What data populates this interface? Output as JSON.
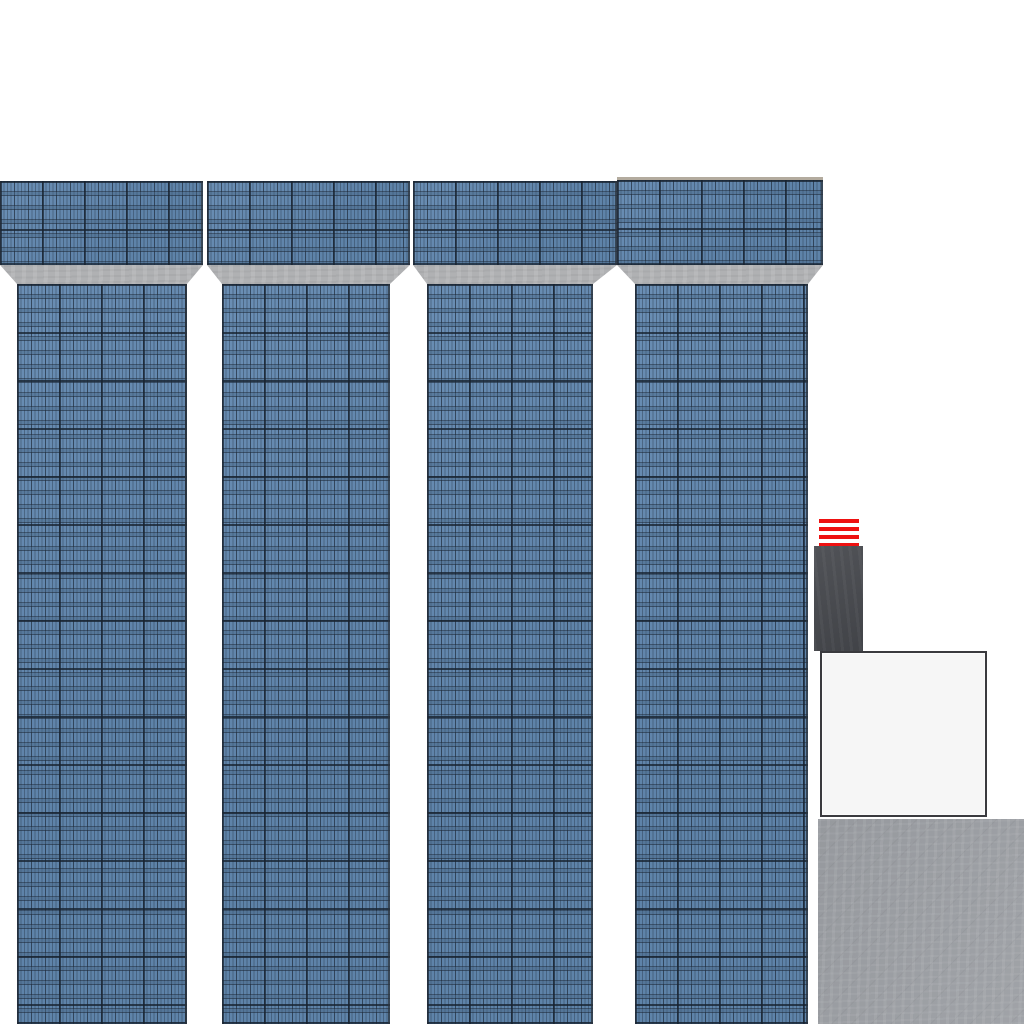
{
  "image": {
    "kind": "texture-atlas",
    "width_px": 1024,
    "height_px": 1024
  },
  "palette": {
    "background_white": "#ffffff",
    "facade_blue": "#6288b0",
    "facade_line_dark": "#1f2c3b",
    "ledge_gray": "#b0b1b3",
    "ledge_gray_light": "#babbbd",
    "trim_tan": "#b3ab9e",
    "stripe_red": "#ee1111",
    "dark_block_gray": "#47494e",
    "panel_fill": "#f6f6f6",
    "panel_border": "#3a3a3e",
    "concrete_gray": "#9b9ea3"
  },
  "sprites": {
    "facade_strips": [
      {
        "name": "facade-strip-1",
        "top": {
          "x": 0,
          "y": 181,
          "w": 203,
          "h": 84
        },
        "ledge": {
          "x": 0,
          "y": 265,
          "w": 203,
          "h": 19,
          "bottom_left": 17,
          "bottom_right": 187
        },
        "shaft": {
          "x": 17,
          "y": 284,
          "w": 170,
          "h": 740
        }
      },
      {
        "name": "facade-strip-2",
        "top": {
          "x": 207,
          "y": 181,
          "w": 203,
          "h": 84
        },
        "ledge": {
          "x": 207,
          "y": 265,
          "w": 203,
          "h": 19,
          "bottom_left": 222,
          "bottom_right": 390
        },
        "shaft": {
          "x": 222,
          "y": 284,
          "w": 168,
          "h": 740
        }
      },
      {
        "name": "facade-strip-3",
        "top": {
          "x": 413,
          "y": 181,
          "w": 204,
          "h": 84
        },
        "ledge": {
          "x": 413,
          "y": 265,
          "w": 204,
          "h": 19,
          "bottom_left": 427,
          "bottom_right": 593
        },
        "shaft": {
          "x": 427,
          "y": 284,
          "w": 166,
          "h": 740
        }
      },
      {
        "name": "facade-strip-4",
        "has_top_trim": true,
        "top": {
          "x": 617,
          "y": 177,
          "w": 206,
          "h": 88
        },
        "ledge": {
          "x": 617,
          "y": 265,
          "w": 206,
          "h": 19,
          "bottom_left": 635,
          "bottom_right": 808
        },
        "shaft": {
          "x": 635,
          "y": 284,
          "w": 173,
          "h": 740
        }
      }
    ],
    "red_stripe_marker": {
      "x": 819,
      "y": 519,
      "w": 40,
      "h": 28,
      "stripe_count": 4,
      "stripe_height": 4,
      "stripe_gap": 4
    },
    "dark_block": {
      "x": 814,
      "y": 546,
      "w": 49,
      "h": 105
    },
    "white_panel": {
      "x": 820,
      "y": 651,
      "w": 167,
      "h": 166,
      "border_width": 2
    },
    "concrete_tile": {
      "x": 818,
      "y": 819,
      "w": 206,
      "h": 205
    }
  }
}
